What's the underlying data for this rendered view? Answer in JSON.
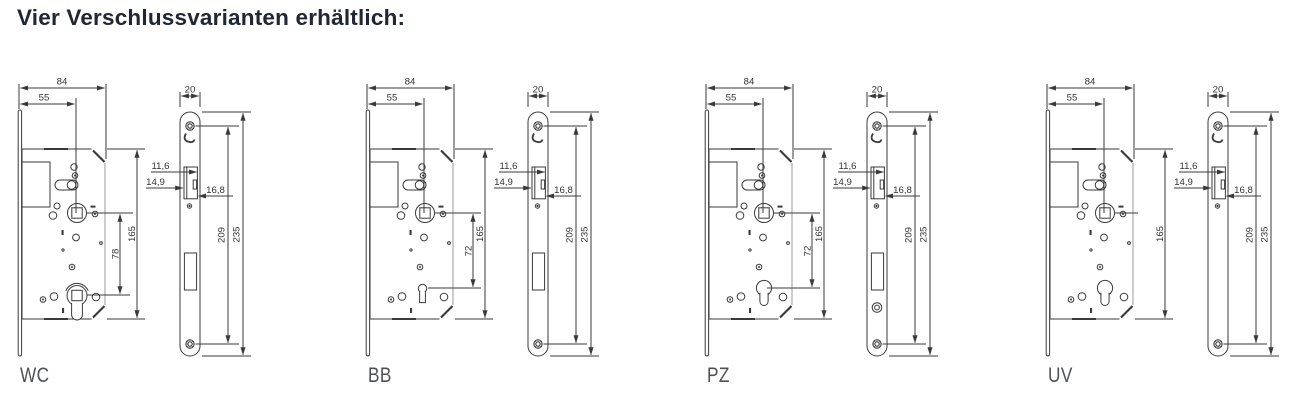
{
  "title": "Vier Verschlussvarianten erhältlich:",
  "colors": {
    "background": "#ffffff",
    "title_text": "#202634",
    "drawing_line": "#3a3a3a",
    "dimension_text": "#333333",
    "variant_label": "#4e5054"
  },
  "variants": [
    {
      "label": "WC",
      "dims": {
        "body_width": "84",
        "backset": "55",
        "body_height": "165",
        "follower_distance": "78",
        "faceplate_width": "20",
        "latch_dim_top": "11,6",
        "latch_dim_mid": "14,9",
        "latch_dim_side": "16,8",
        "screw_spacing": "209",
        "faceplate_height": "235"
      }
    },
    {
      "label": "BB",
      "dims": {
        "body_width": "84",
        "backset": "55",
        "body_height": "165",
        "follower_distance": "72",
        "faceplate_width": "20",
        "latch_dim_top": "11,6",
        "latch_dim_mid": "14,9",
        "latch_dim_side": "16,8",
        "screw_spacing": "209",
        "faceplate_height": "235"
      }
    },
    {
      "label": "PZ",
      "dims": {
        "body_width": "84",
        "backset": "55",
        "body_height": "165",
        "follower_distance": "72",
        "faceplate_width": "20",
        "latch_dim_top": "11,6",
        "latch_dim_mid": "14,9",
        "latch_dim_side": "16,8",
        "screw_spacing": "209",
        "faceplate_height": "235"
      }
    },
    {
      "label": "UV",
      "dims": {
        "body_width": "84",
        "backset": "55",
        "body_height": "165",
        "faceplate_width": "20",
        "latch_dim_top": "11,6",
        "latch_dim_mid": "14,9",
        "latch_dim_side": "16,8",
        "screw_spacing": "209",
        "faceplate_height": "235"
      }
    }
  ]
}
